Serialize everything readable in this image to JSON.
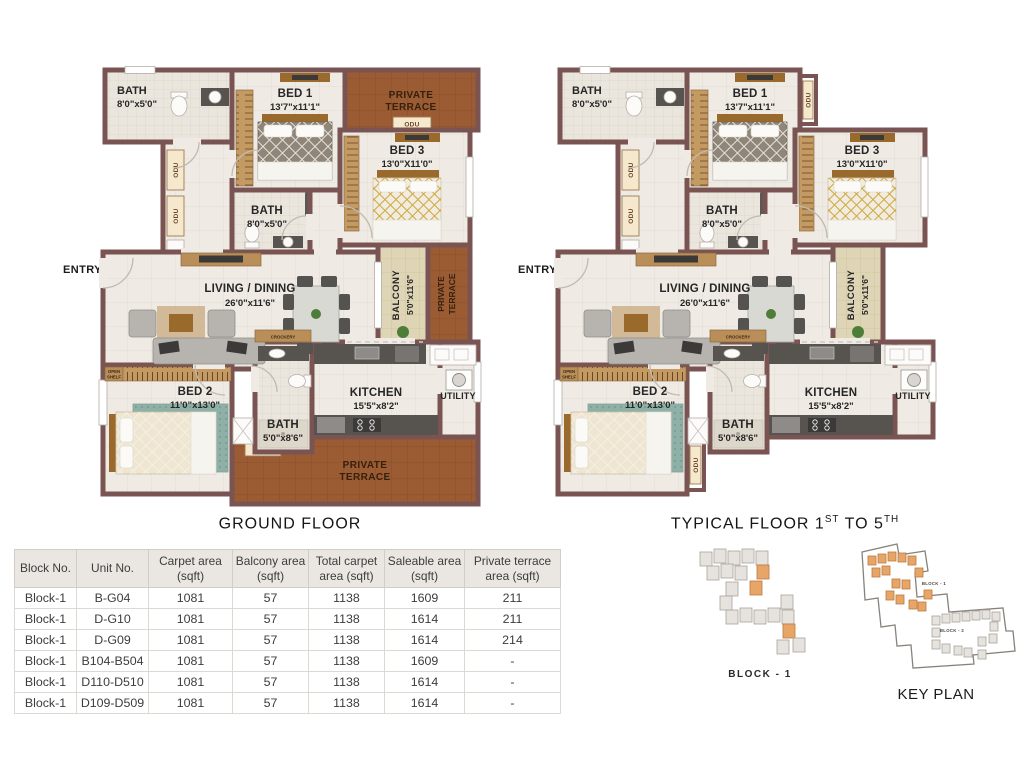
{
  "plans": [
    {
      "id": "ground",
      "show_terrace": true,
      "caption": {
        "p1": "GROUND FLOOR",
        "p2": "",
        "p3": "",
        "p4": ""
      },
      "labels": {
        "entry": "ENTRY",
        "bath_tl": "BATH",
        "bath_tl_dim": "8'0\"x5'0\"",
        "bed1": "BED 1",
        "bed1_dim": "13'7\"x11'1\"",
        "bed3": "BED 3",
        "bed3_dim": "13'0\"X11'0\"",
        "bath_mid": "BATH",
        "bath_mid_dim": "8'0\"x5'0\"",
        "living": "LIVING / DINING",
        "living_dim": "26'0\"x11'6\"",
        "balcony": "BALCONY",
        "balcony_dim": "5'0\"x11'6\"",
        "bed2": "BED 2",
        "bed2_dim": "11'0\"x13'0\"",
        "bath_br": "BATH",
        "bath_br_dim": "5'0\"x8'6\"",
        "kitchen": "KITCHEN",
        "kitchen_dim": "15'5\"x8'2\"",
        "utility": "UTILITY",
        "terrace1": "PRIVATE",
        "terrace2": "TERRACE",
        "odu": "ODU",
        "crockery": "CROCKERY",
        "open_shelf_1": "OPEN",
        "open_shelf_2": "SHELF"
      }
    },
    {
      "id": "typical",
      "show_terrace": false,
      "caption": {
        "p1": "TYPICAL FLOOR 1",
        "p2": "ST",
        "p3": " TO 5",
        "p4": "TH"
      },
      "labels": {
        "entry": "ENTRY",
        "bath_tl": "BATH",
        "bath_tl_dim": "8'0\"x5'0\"",
        "bed1": "BED 1",
        "bed1_dim": "13'7\"x11'1\"",
        "bed3": "BED 3",
        "bed3_dim": "13'0\"X11'0\"",
        "bath_mid": "BATH",
        "bath_mid_dim": "8'0\"x5'0\"",
        "living": "LIVING / DINING",
        "living_dim": "26'0\"x11'6\"",
        "balcony": "BALCONY",
        "balcony_dim": "5'0\"x11'6\"",
        "bed2": "BED 2",
        "bed2_dim": "11'0\"x13'0\"",
        "bath_br": "BATH",
        "bath_br_dim": "5'0\"x8'6\"",
        "kitchen": "KITCHEN",
        "kitchen_dim": "15'5\"x8'2\"",
        "utility": "UTILITY",
        "odu": "ODU",
        "crockery": "CROCKERY",
        "open_shelf_1": "OPEN",
        "open_shelf_2": "SHELF"
      }
    }
  ],
  "table": {
    "headers": [
      "Block No.",
      "Unit No.",
      "Carpet area (sqft)",
      "Balcony area (sqft)",
      "Total carpet area (sqft)",
      "Saleable area (sqft)",
      "Private terrace area (sqft)"
    ],
    "rows": [
      [
        "Block-1",
        "B-G04",
        "1081",
        "57",
        "1138",
        "1609",
        "211"
      ],
      [
        "Block-1",
        "D-G10",
        "1081",
        "57",
        "1138",
        "1614",
        "211"
      ],
      [
        "Block-1",
        "D-G09",
        "1081",
        "57",
        "1138",
        "1614",
        "214"
      ],
      [
        "Block-1",
        "B104-B504",
        "1081",
        "57",
        "1138",
        "1609",
        "-"
      ],
      [
        "Block-1",
        "D110-D510",
        "1081",
        "57",
        "1138",
        "1614",
        "-"
      ],
      [
        "Block-1",
        "D109-D509",
        "1081",
        "57",
        "1138",
        "1614",
        "-"
      ]
    ]
  },
  "key_plans": {
    "block1_caption": "BLOCK - 1",
    "keyplan_caption": "KEY PLAN",
    "block1_label": "BLOCK - 1",
    "block2_label": "BLOCK - 2"
  },
  "colors": {
    "wall": "#7a5452",
    "terrace": "#9c5c33",
    "balcony": "#ded4b6",
    "entry_arrow": "#c8242b",
    "highlight_unit": "#e8a568"
  }
}
